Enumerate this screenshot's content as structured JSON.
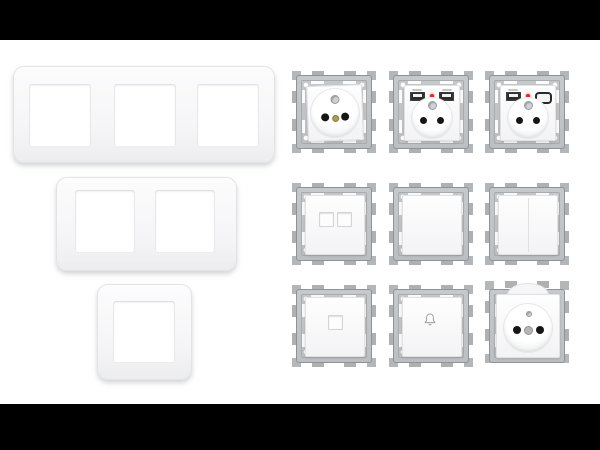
{
  "image": {
    "kind": "product-photo",
    "description": "White modular electrical wiring devices: three finishing frame plates and nine mechanism modules on metal mounting frames",
    "background": "#ffffff",
    "letterbox": {
      "color": "#000000",
      "top_height_px": 40,
      "bottom_height_px": 46
    }
  },
  "colors": {
    "frame_metal": "#c0c3c5",
    "frame_edge": "#8f9395",
    "claw_metal": "#aeb1b3",
    "plate_white": "#f5f5f7",
    "plaque_white": "#fdfdfd",
    "socket_hole": "#161616",
    "earth_screw_gold": "#b09a58",
    "led_red": "#e02a1e",
    "icon_gray": "#9aa0a3"
  },
  "plates": [
    {
      "name": "triple-gang-frame-plate",
      "gangs": 3
    },
    {
      "name": "double-gang-frame-plate",
      "gangs": 2
    },
    {
      "name": "single-gang-frame-plate",
      "gangs": 1
    }
  ],
  "modules": [
    {
      "name": "french-socket-2p-earth",
      "row": 1,
      "col": 1,
      "features": [
        "earth-pin",
        "two-holes",
        "gold-center-screw"
      ]
    },
    {
      "name": "french-socket-dual-usb-a",
      "row": 1,
      "col": 2,
      "features": [
        "usb-a-port",
        "usb-a-port",
        "red-led"
      ]
    },
    {
      "name": "french-socket-usb-a-usb-c",
      "row": 1,
      "col": 3,
      "features": [
        "usb-a-port",
        "usb-c-port",
        "red-led"
      ]
    },
    {
      "name": "dual-rj45-outlet",
      "row": 2,
      "col": 1,
      "features": [
        "two-square-ports"
      ]
    },
    {
      "name": "single-rocker-switch",
      "row": 2,
      "col": 2,
      "features": [
        "plain-rocker"
      ]
    },
    {
      "name": "double-rocker-switch",
      "row": 2,
      "col": 3,
      "features": [
        "split-rocker"
      ]
    },
    {
      "name": "single-rj45-outlet",
      "row": 3,
      "col": 1,
      "features": [
        "one-square-port"
      ]
    },
    {
      "name": "doorbell-push-button",
      "row": 3,
      "col": 2,
      "icon": "bell-icon"
    },
    {
      "name": "french-socket-with-flap-lid",
      "row": 3,
      "col": 3,
      "features": [
        "lid-flap",
        "earth-pin",
        "two-holes",
        "gray-center-screw"
      ]
    }
  ]
}
